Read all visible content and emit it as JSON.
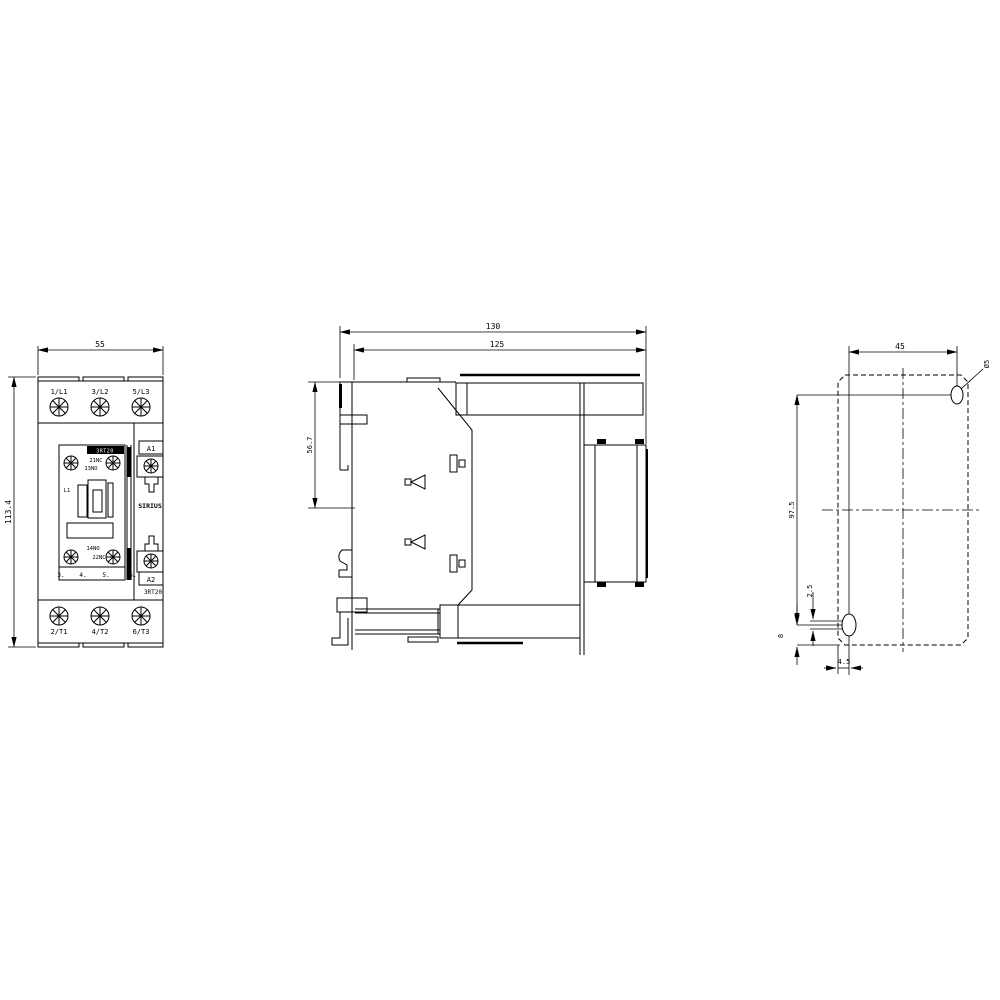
{
  "front_view": {
    "dim_width": "55",
    "dim_height": "113.4",
    "terminals_top": [
      "1/L1",
      "3/L2",
      "5/L3"
    ],
    "terminals_bottom": [
      "2/T1",
      "4/T2",
      "6/T3"
    ],
    "aux_top_nc": "21NC",
    "aux_top_no": "13NO",
    "aux_bottom_no": "14NO",
    "aux_bottom_nc": "22NC",
    "coil_marker": "L1",
    "coil_a1": "A1",
    "coil_a2": "A2",
    "brand": "SIRIUS",
    "model": "3RT20",
    "band_text": "3RT20",
    "position_numbers": [
      "3.",
      "4.",
      "5.",
      "5."
    ]
  },
  "side_view": {
    "dim_depth_total": "130",
    "dim_depth_body": "125",
    "dim_top_to_rail": "56.7"
  },
  "drill_plan": {
    "dim_hole_pitch_x": "45",
    "dim_hole_pitch_y": "97.5",
    "dim_slot_play": "2.5",
    "dim_bottom_offset": "8",
    "dim_edge_offset": "4.5",
    "hole_diameter": "Ø5"
  }
}
